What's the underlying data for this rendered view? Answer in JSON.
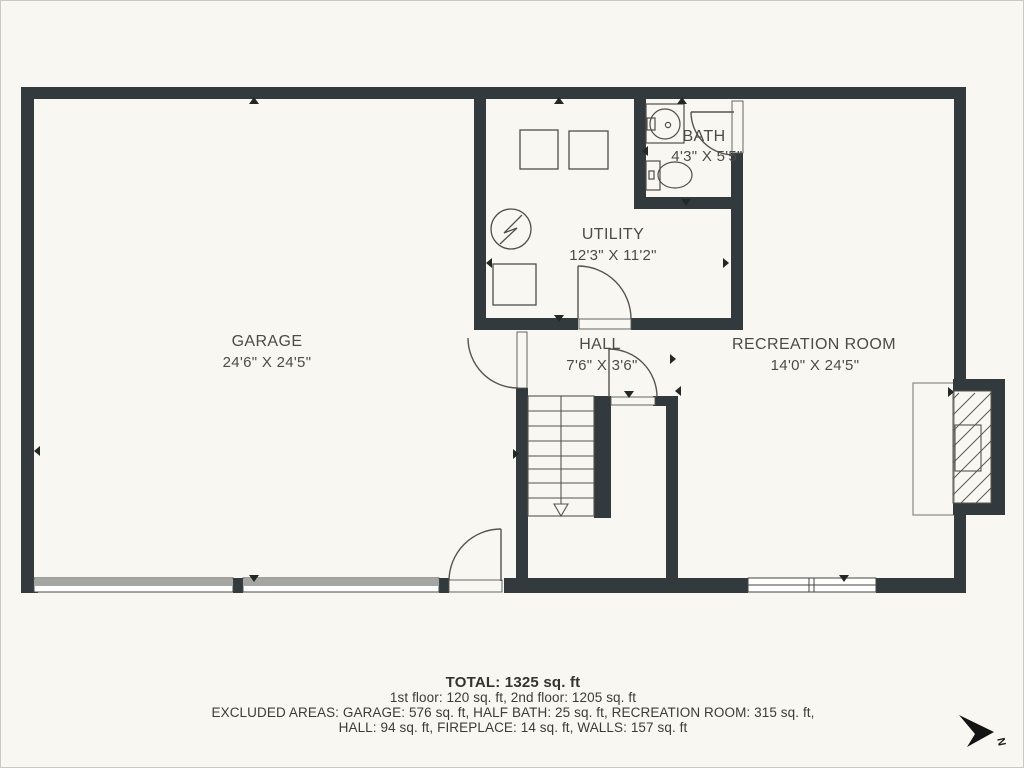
{
  "palette": {
    "background": "#f8f7f2",
    "wall": "#333a3e",
    "thin_line": "#55544e",
    "text": "#4c4b44",
    "garage_door_band": "#a3a6a3"
  },
  "rooms": [
    {
      "id": "garage",
      "name": "GARAGE",
      "dimensions": "24'6\" X 24'5\""
    },
    {
      "id": "utility",
      "name": "UTILITY",
      "dimensions": "12'3\" X 11'2\""
    },
    {
      "id": "bath",
      "name": "BATH",
      "dimensions": "4'3\" X 5'5\""
    },
    {
      "id": "hall",
      "name": "HALL",
      "dimensions": "7'6\" X 3'6\""
    },
    {
      "id": "recreation-room",
      "name": "RECREATION ROOM",
      "dimensions": "14'0\" X 24'5\""
    }
  ],
  "summary": {
    "total": "TOTAL: 1325 sq. ft",
    "floors": "1st floor: 120 sq. ft, 2nd floor: 1205 sq. ft",
    "excluded_line1": "EXCLUDED AREAS: GARAGE: 576 sq. ft, HALF BATH: 25 sq. ft, RECREATION ROOM: 315 sq. ft,",
    "excluded_line2": "HALL: 94 sq. ft, FIREPLACE: 14 sq. ft, WALLS: 157 sq. ft"
  },
  "compass": {
    "label": "N"
  }
}
